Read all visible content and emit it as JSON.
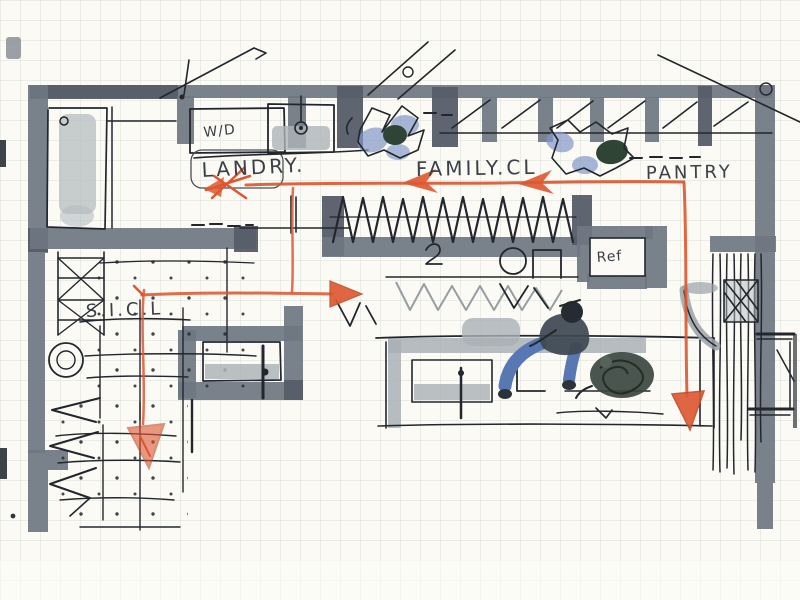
{
  "meta": {
    "type": "hand-drawn architectural floor plan sketch",
    "medium": "ink and gray marker on graph paper with orange circulation arrows"
  },
  "labels": {
    "laundry": "LANDRY.",
    "family_closet": "FAMILY.CL",
    "pantry": "PANTRY",
    "sicl": "S.I.C.L",
    "washer_dryer": "W/D",
    "refrigerator": "Ref"
  },
  "colors": {
    "paper": "#fbfaf5",
    "grid": "#d9ded6",
    "wall_marker": "#6e7681",
    "ink": "#23272d",
    "flow_accent": "#de5730",
    "figure_blue": "#8195c8",
    "scribble_green": "#2f4435",
    "counter_gray": "#a9b0b5"
  },
  "annotations": {
    "flow_arrows": [
      {
        "name": "arrow-left-into-laundry",
        "direction": "left"
      },
      {
        "name": "arrow-left-closet-west",
        "direction": "left"
      },
      {
        "name": "arrow-left-closet-east",
        "direction": "left"
      },
      {
        "name": "arrow-down-pantry",
        "direction": "down"
      },
      {
        "name": "arrow-right-corridor",
        "direction": "right"
      },
      {
        "name": "arrow-down-mudroom",
        "direction": "down"
      }
    ]
  }
}
